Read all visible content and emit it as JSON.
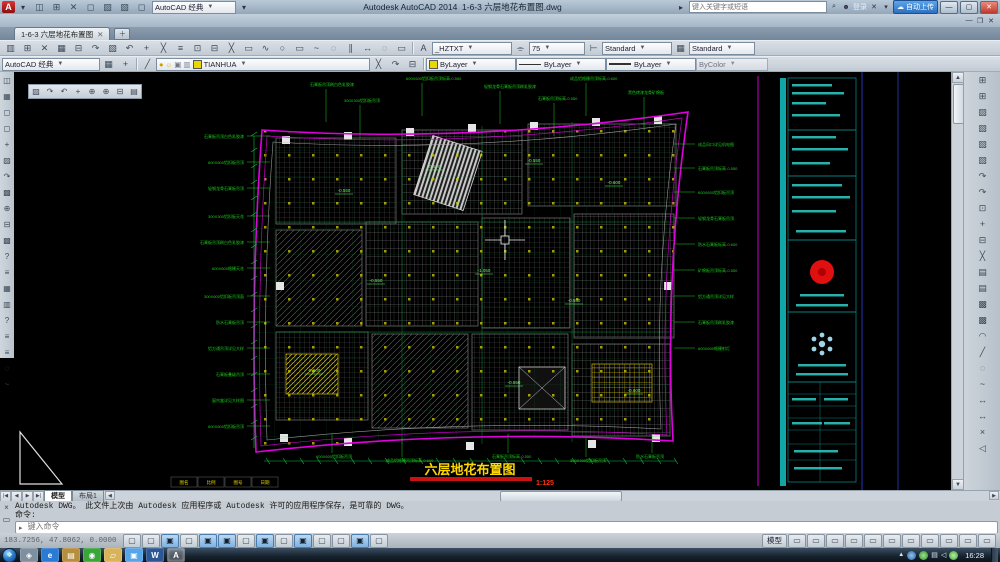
{
  "titlebar": {
    "app_title": "Autodesk AutoCAD 2014",
    "doc_title": "1-6-3 六层地花布置图.dwg",
    "workspace": "AutoCAD 经典",
    "search_placeholder": "键入关键字或短语",
    "signin": "登录",
    "cloud_button": "自动上传"
  },
  "menubar": {
    "items": [
      "文件(F)",
      "编辑(E)",
      "视图(V)",
      "插入(I)",
      "格式(O)",
      "工具(T)",
      "绘图(D)",
      "标注(N)",
      "修改(M)",
      "参数(P)",
      "窗口(W)",
      "Acrobat 标记(C)",
      "Adobe PDF(B)",
      "帮助(H)"
    ]
  },
  "doc_tab": {
    "label": "1-6-3 六层地花布置图"
  },
  "toolbars": {
    "workspace": "AutoCAD 经典",
    "text_style": "_HZTXT",
    "text_height": "75",
    "dim_style": "Standard",
    "table_style": "Standard",
    "layer": "TIANHUA",
    "color": "ByLayer",
    "linetype": "ByLayer",
    "lineweight": "ByLayer",
    "plot_style": "ByColor"
  },
  "icons": {
    "quick_access": [
      "qnew",
      "open",
      "save",
      "save-as",
      "plot",
      "undo",
      "redo"
    ],
    "standard_toolbar": [
      "new",
      "open",
      "save",
      "plot",
      "plot-preview",
      "publish",
      "cut",
      "copy",
      "paste",
      "match-properties",
      "block-editor",
      "undo",
      "redo",
      "pan-realtime",
      "zoom-realtime",
      "zoom-window",
      "zoom-previous",
      "properties",
      "design-center",
      "tool-palettes",
      "sheet-set-manager",
      "markup-set-manager",
      "quick-calc",
      "help"
    ],
    "layer_tools": [
      "layer-properties-manager"
    ],
    "layer_extra": [
      "make-object-layer-current",
      "layer-match",
      "layer-previous"
    ],
    "workspace_extra": [
      "workspace-settings",
      "my-workspace"
    ],
    "draw_toolbar": [
      "line",
      "construction-line",
      "polyline",
      "polygon",
      "rectangle",
      "arc",
      "circle",
      "revision-cloud",
      "spline",
      "ellipse",
      "ellipse-arc",
      "insert-block",
      "make-block",
      "point",
      "hatch",
      "gradient",
      "region",
      "table",
      "multiline-text",
      "add-selected"
    ],
    "modify_toolbar": [
      "erase",
      "copy",
      "mirror",
      "offset",
      "array",
      "move",
      "rotate",
      "scale",
      "stretch",
      "trim",
      "extend",
      "break-at-point",
      "break",
      "join",
      "chamfer",
      "fillet",
      "blend-curves",
      "explode"
    ],
    "draw_order_toolbar": [
      "bring-to-front",
      "send-to-back",
      "bring-above-objects",
      "send-under-objects",
      "text-to-front",
      "hatch-to-back"
    ],
    "view_floatbar": [
      "top-view",
      "bottom-view",
      "left-view",
      "right-view",
      "front-view",
      "back-view",
      "swiso-view",
      "seiso-view"
    ],
    "status_right": [
      "quick-view-layouts",
      "quick-view-drawings",
      "pan",
      "zoom",
      "steering-wheel",
      "show-motion",
      "annotation-visibility",
      "autoscale",
      "workspace-switching",
      "toolbar-lock",
      "clean-screen"
    ]
  },
  "status_toggles": [
    {
      "name": "infer-constraints",
      "on": false
    },
    {
      "name": "snap-mode",
      "on": false
    },
    {
      "name": "grid-display",
      "on": true
    },
    {
      "name": "ortho-mode",
      "on": false
    },
    {
      "name": "polar-tracking",
      "on": true
    },
    {
      "name": "object-snap",
      "on": true
    },
    {
      "name": "3d-object-snap",
      "on": false
    },
    {
      "name": "object-snap-tracking",
      "on": true
    },
    {
      "name": "dynamic-ucs",
      "on": false
    },
    {
      "name": "dynamic-input",
      "on": true
    },
    {
      "name": "lineweight",
      "on": false
    },
    {
      "name": "transparency",
      "on": false
    },
    {
      "name": "quick-properties",
      "on": true
    },
    {
      "name": "selection-cycling",
      "on": false
    }
  ],
  "drawing": {
    "title": "六层地花布置图",
    "scale": "1:125",
    "bottom_cells": [
      "图名",
      "比例",
      "图号",
      "日期"
    ],
    "annotations": [
      {
        "x": 230,
        "y": 66,
        "t": "石膏板吊顶白色乳胶漆",
        "s": "L"
      },
      {
        "x": 230,
        "y": 92,
        "t": "600X600铝扣板吊顶",
        "s": "L"
      },
      {
        "x": 230,
        "y": 118,
        "t": "轻钢龙骨石膏板吊顶",
        "s": "L"
      },
      {
        "x": 230,
        "y": 146,
        "t": "300X300铝扣板天花",
        "s": "L"
      },
      {
        "x": 230,
        "y": 172,
        "t": "石膏板吊顶刷白色乳胶漆",
        "s": "L"
      },
      {
        "x": 230,
        "y": 198,
        "t": "600X600格栅天花",
        "s": "L"
      },
      {
        "x": 230,
        "y": 226,
        "t": "300X600铝扣板吊顶面",
        "s": "L"
      },
      {
        "x": 230,
        "y": 252,
        "t": "防水石膏板吊顶",
        "s": "L"
      },
      {
        "x": 230,
        "y": 278,
        "t": "铝方通吊顶详见大样",
        "s": "L"
      },
      {
        "x": 230,
        "y": 304,
        "t": "石膏板叠级吊顶",
        "s": "L"
      },
      {
        "x": 230,
        "y": 330,
        "t": "窗帘盒详见大样图",
        "s": "L"
      },
      {
        "x": 230,
        "y": 356,
        "t": "600X600铝扣板吊顶",
        "s": "L"
      },
      {
        "x": 296,
        "y": 14,
        "t": "石膏板吊顶刷白色乳胶漆",
        "s": "T"
      },
      {
        "x": 392,
        "y": 8,
        "t": "600X600铝扣板吊顶标高-0.550",
        "s": "T"
      },
      {
        "x": 330,
        "y": 30,
        "t": "300X300铝扣板吊顶",
        "s": "T"
      },
      {
        "x": 470,
        "y": 16,
        "t": "轻钢龙骨石膏板吊顶刷乳胶漆",
        "s": "T"
      },
      {
        "x": 524,
        "y": 28,
        "t": "石膏板吊顶标高-0.550",
        "s": "T"
      },
      {
        "x": 556,
        "y": 8,
        "t": "成品铝格栅吊顶标高-0.600",
        "s": "T"
      },
      {
        "x": 614,
        "y": 22,
        "t": "黑色烤漆龙骨矿棉板",
        "s": "T"
      },
      {
        "x": 684,
        "y": 74,
        "t": "成品风口详见机电图",
        "s": "R"
      },
      {
        "x": 684,
        "y": 98,
        "t": "石膏板吊顶标高-0.550",
        "s": "R"
      },
      {
        "x": 684,
        "y": 122,
        "t": "600X600铝扣板吊顶",
        "s": "R"
      },
      {
        "x": 684,
        "y": 148,
        "t": "轻钢龙骨石膏板吊顶",
        "s": "R"
      },
      {
        "x": 684,
        "y": 174,
        "t": "防水石膏板标高-0.600",
        "s": "R"
      },
      {
        "x": 684,
        "y": 200,
        "t": "矿棉板吊顶标高-0.550",
        "s": "R"
      },
      {
        "x": 684,
        "y": 226,
        "t": "铝方通吊顶详见大样",
        "s": "R"
      },
      {
        "x": 684,
        "y": 252,
        "t": "石膏板吊顶刷乳胶漆",
        "s": "R"
      },
      {
        "x": 684,
        "y": 278,
        "t": "600X600格栅射灯",
        "s": "R"
      },
      {
        "x": 302,
        "y": 386,
        "t": "600X600铝扣板吊顶",
        "s": "B"
      },
      {
        "x": 372,
        "y": 390,
        "t": "成品铝格栅吊顶标高-0.600",
        "s": "B"
      },
      {
        "x": 478,
        "y": 386,
        "t": "石膏板吊顶标高-0.550",
        "s": "B"
      },
      {
        "x": 556,
        "y": 390,
        "t": "300X300铝扣板吊顶",
        "s": "B"
      },
      {
        "x": 622,
        "y": 386,
        "t": "防水石膏板吊顶",
        "s": "B"
      },
      {
        "x": 330,
        "y": 120,
        "t": "-0.550",
        "s": "E"
      },
      {
        "x": 420,
        "y": 96,
        "t": "-0.600",
        "s": "E"
      },
      {
        "x": 520,
        "y": 90,
        "t": "-0.550",
        "s": "E"
      },
      {
        "x": 600,
        "y": 112,
        "t": "-0.600",
        "s": "E"
      },
      {
        "x": 362,
        "y": 210,
        "t": "-0.550",
        "s": "E"
      },
      {
        "x": 470,
        "y": 200,
        "t": "-1.050",
        "s": "E"
      },
      {
        "x": 560,
        "y": 230,
        "t": "-0.550",
        "s": "E"
      },
      {
        "x": 300,
        "y": 300,
        "t": "-0.600",
        "s": "E"
      },
      {
        "x": 500,
        "y": 312,
        "t": "-0.550",
        "s": "E"
      },
      {
        "x": 620,
        "y": 320,
        "t": "-0.600",
        "s": "E"
      }
    ]
  },
  "command": {
    "history": [
      "Autodesk DWG。 此文件上次由 Autodesk 应用程序或 Autodesk 许可的应用程序保存，是可靠的 DWG。",
      "命令:"
    ],
    "input_placeholder": "键入命令"
  },
  "statusbar": {
    "coords": "183.7256, 47.8062, 0.0000",
    "space_button": "模型"
  },
  "tabs": {
    "model": "模型",
    "layout1": "布局1"
  },
  "taskbar": {
    "clock": "16:28",
    "buttons": [
      {
        "name": "media-player",
        "g": "◈",
        "c": "#7e8fa0",
        "active": false
      },
      {
        "name": "internet-explorer",
        "g": "e",
        "c": "#2b7bd4",
        "active": false
      },
      {
        "name": "file-manager-group",
        "g": "▤",
        "c": "#b58f3e",
        "active": false
      },
      {
        "name": "qq",
        "g": "◉",
        "c": "#3aa63a",
        "active": false
      },
      {
        "name": "folder",
        "g": "▱",
        "c": "#d9b35a",
        "active": false
      },
      {
        "name": "notes-app",
        "g": "▣",
        "c": "#56a5e8",
        "active": false
      },
      {
        "name": "word",
        "g": "W",
        "c": "#2b5797",
        "active": false
      },
      {
        "name": "autocad",
        "g": "A",
        "c": "#b03030",
        "active": true
      }
    ]
  }
}
